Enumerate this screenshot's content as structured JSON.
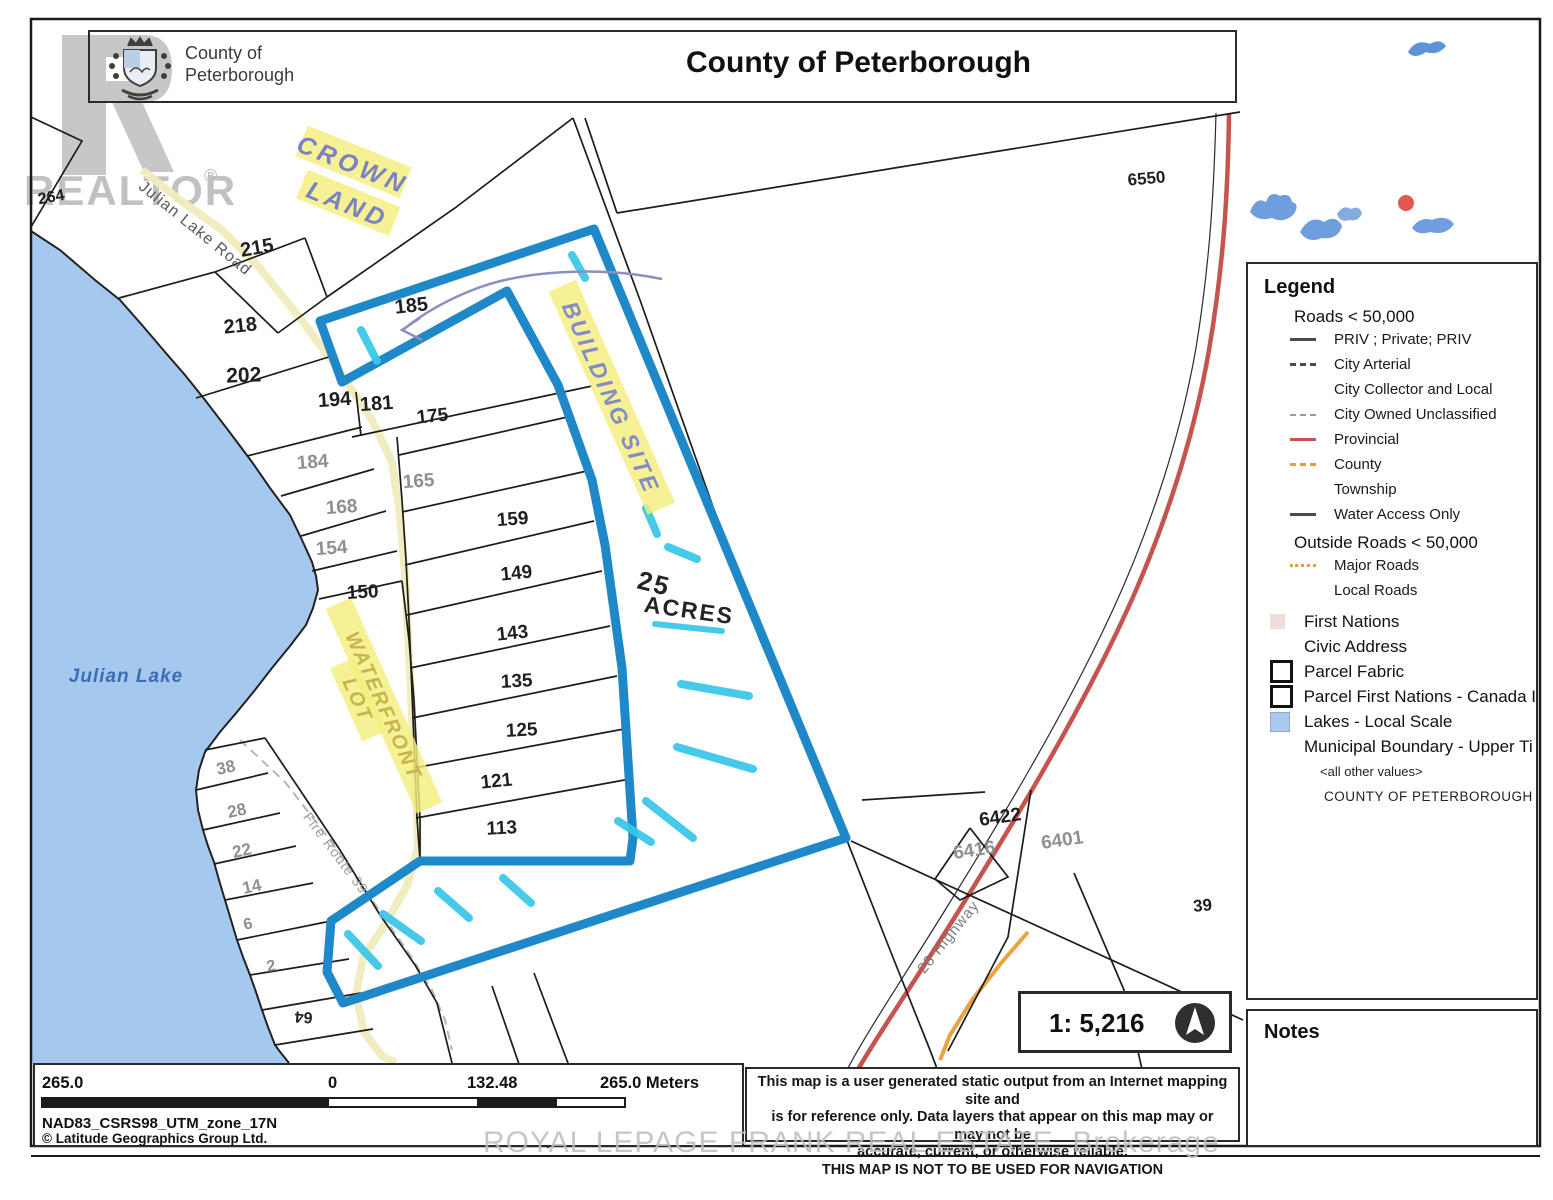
{
  "header": {
    "org_line1": "County of",
    "org_line2": "Peterborough",
    "title": "County of Peterborough"
  },
  "watermarks": {
    "realtor": "REALTOR",
    "registered": "®",
    "brokerage": "ROYAL LEPAGE FRANK REAL ESTATE, Brokerage"
  },
  "legend": {
    "title": "Legend",
    "roads_heading": "Roads < 50,000",
    "road_items": [
      {
        "label": "PRIV ; Private; PRIV",
        "swatch": "l-dark"
      },
      {
        "label": "City Arterial",
        "swatch": "l-dashdark"
      },
      {
        "label": "City Collector and Local",
        "swatch": "none"
      },
      {
        "label": "City Owned Unclassified",
        "swatch": "l-dashgray"
      },
      {
        "label": "Provincial",
        "swatch": "l-red"
      },
      {
        "label": "County",
        "swatch": "l-dashor"
      },
      {
        "label": "Township",
        "swatch": "none"
      },
      {
        "label": "Water Access Only",
        "swatch": "l-dark"
      }
    ],
    "outside_heading": "Outside Roads < 50,000",
    "outside_items": [
      {
        "label": "Major Roads",
        "swatch": "l-dotor"
      },
      {
        "label": "Local Roads",
        "swatch": "none"
      }
    ],
    "area_items": [
      {
        "label": "First Nations",
        "swatch": "sq-pink"
      },
      {
        "label": "Civic Address",
        "swatch": "none"
      },
      {
        "label": "Parcel Fabric",
        "swatch": "sq-white"
      },
      {
        "label": "Parcel First Nations - Canada I",
        "swatch": "sq-white"
      },
      {
        "label": "Lakes - Local Scale",
        "swatch": "sq-blue"
      },
      {
        "label": "Municipal Boundary - Upper Ti",
        "swatch": "none"
      }
    ],
    "all_other_values": "<all other values>",
    "county_value": "COUNTY OF PETERBOROUGH"
  },
  "notes": {
    "title": "Notes"
  },
  "scale_box": {
    "ratio": "1: 5,216"
  },
  "scale_bar": {
    "left": "265.0",
    "zero": "0",
    "mid": "132.48",
    "right": "265.0 Meters",
    "datum": "NAD83_CSRS98_UTM_zone_17N",
    "copyright": "© Latitude Geographics Group Ltd."
  },
  "disclaimer": {
    "line1": "This map is a user generated static output from an Internet mapping site and",
    "line2": "is for reference only. Data layers that appear on this map may or may not be",
    "line3": "accurate, current, or otherwise reliable.",
    "line4": "THIS MAP IS NOT TO BE USED FOR NAVIGATION"
  },
  "map": {
    "labels": [
      {
        "t": "Julian Lake",
        "x": 126,
        "y": 682,
        "r": 0,
        "c": "#3c6cb4",
        "s": 19,
        "i": true,
        "w": 600,
        "ls": 1
      },
      {
        "t": "Julian Lake Road",
        "x": 192,
        "y": 232,
        "r": 39,
        "c": "#5a5a5a",
        "s": 16,
        "ls": 1
      },
      {
        "t": "Fire Route 39",
        "x": 332,
        "y": 856,
        "r": 53,
        "c": "#9c9c9c",
        "s": 14,
        "ls": 1
      },
      {
        "t": "28 Highway",
        "x": 952,
        "y": 940,
        "r": -51,
        "c": "#7a7a7a",
        "s": 15,
        "ls": 1
      }
    ],
    "parcels": [
      {
        "t": "264",
        "x": 52,
        "y": 202,
        "r": -10,
        "c": "d",
        "s": 16
      },
      {
        "t": "215",
        "x": 258,
        "y": 254,
        "r": -10,
        "c": "d",
        "s": 20
      },
      {
        "t": "218",
        "x": 241,
        "y": 332,
        "r": -6,
        "c": "d",
        "s": 20
      },
      {
        "t": "202",
        "x": 244,
        "y": 382,
        "r": -2,
        "c": "d",
        "s": 21
      },
      {
        "t": "194",
        "x": 335,
        "y": 406,
        "r": -4,
        "c": "d",
        "s": 20
      },
      {
        "t": "181",
        "x": 377,
        "y": 410,
        "r": -4,
        "c": "d",
        "s": 20
      },
      {
        "t": "185",
        "x": 412,
        "y": 312,
        "r": -6,
        "c": "d",
        "s": 20
      },
      {
        "t": "175",
        "x": 433,
        "y": 422,
        "r": -6,
        "c": "d",
        "s": 19
      },
      {
        "t": "184",
        "x": 313,
        "y": 468,
        "r": -4,
        "c": "g",
        "s": 19
      },
      {
        "t": "165",
        "x": 419,
        "y": 487,
        "r": -4,
        "c": "g",
        "s": 19
      },
      {
        "t": "168",
        "x": 342,
        "y": 513,
        "r": -4,
        "c": "g",
        "s": 19
      },
      {
        "t": "159",
        "x": 513,
        "y": 525,
        "r": -4,
        "c": "d",
        "s": 19
      },
      {
        "t": "154",
        "x": 332,
        "y": 554,
        "r": -4,
        "c": "g",
        "s": 19
      },
      {
        "t": "149",
        "x": 517,
        "y": 579,
        "r": -6,
        "c": "d",
        "s": 19
      },
      {
        "t": "150",
        "x": 363,
        "y": 598,
        "r": -3,
        "c": "d",
        "s": 19
      },
      {
        "t": "143",
        "x": 513,
        "y": 639,
        "r": -6,
        "c": "d",
        "s": 19
      },
      {
        "t": "135",
        "x": 517,
        "y": 687,
        "r": -3,
        "c": "d",
        "s": 19
      },
      {
        "t": "125",
        "x": 522,
        "y": 736,
        "r": -3,
        "c": "d",
        "s": 19
      },
      {
        "t": "121",
        "x": 497,
        "y": 787,
        "r": -6,
        "c": "d",
        "s": 19
      },
      {
        "t": "113",
        "x": 502,
        "y": 834,
        "r": -3,
        "c": "d",
        "s": 19
      },
      {
        "t": "38",
        "x": 227,
        "y": 773,
        "r": -12,
        "c": "g",
        "s": 17
      },
      {
        "t": "28",
        "x": 238,
        "y": 816,
        "r": -12,
        "c": "g",
        "s": 17
      },
      {
        "t": "22",
        "x": 243,
        "y": 856,
        "r": -12,
        "c": "g",
        "s": 17
      },
      {
        "t": "14",
        "x": 253,
        "y": 892,
        "r": -12,
        "c": "g",
        "s": 17
      },
      {
        "t": "6",
        "x": 249,
        "y": 929,
        "r": -12,
        "c": "g",
        "s": 16
      },
      {
        "t": "2",
        "x": 272,
        "y": 971,
        "r": -10,
        "c": "g",
        "s": 16
      },
      {
        "t": "64",
        "x": 304,
        "y": 1012,
        "r": 184,
        "c": "d",
        "s": 16
      },
      {
        "t": "6550",
        "x": 1147,
        "y": 184,
        "r": -5,
        "c": "d",
        "s": 17
      },
      {
        "t": "6422",
        "x": 1001,
        "y": 823,
        "r": -8,
        "c": "d",
        "s": 19
      },
      {
        "t": "6416",
        "x": 975,
        "y": 856,
        "r": -8,
        "c": "g",
        "s": 19
      },
      {
        "t": "6401",
        "x": 1063,
        "y": 846,
        "r": -8,
        "c": "g",
        "s": 19
      },
      {
        "t": "39",
        "x": 1203,
        "y": 911,
        "r": -5,
        "c": "d",
        "s": 17
      }
    ],
    "annotations": {
      "crown_line1": "CROWN",
      "crown_line2": "LAND",
      "building_site": "BUILDING SITE",
      "waterfront_line1": "WATERFRONT",
      "waterfront_line2": "LOT",
      "acres_line1": "25",
      "acres_line2": "ACRES"
    },
    "colors": {
      "parcel_outline": "#1e88c9",
      "lake": "#a5c8ee",
      "highlight": "#f3ee7d",
      "marker": "#38c6e8",
      "highway": "#c5534e",
      "major_road": "#e8a43e"
    }
  }
}
